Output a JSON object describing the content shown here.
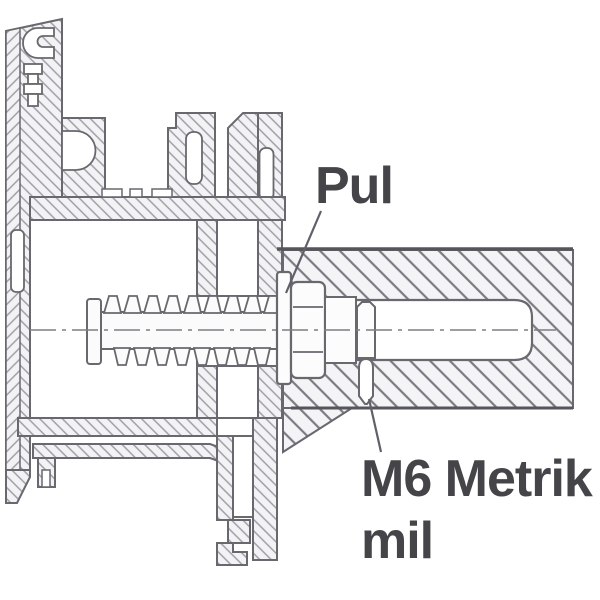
{
  "diagram": {
    "type": "technical-cross-section",
    "description": "Window profile fixed to wall with adjustable anchor screw",
    "labels": {
      "washer": "Pul",
      "stud_line1": "M6 Metrik",
      "stud_line2": "mil"
    },
    "colors": {
      "line": "#68686e",
      "edge_dark": "#55555b",
      "hatch_fine": "#989ba2",
      "hatch_wall": "#7b7b82",
      "text": "#454549",
      "background": "#ffffff"
    }
  }
}
